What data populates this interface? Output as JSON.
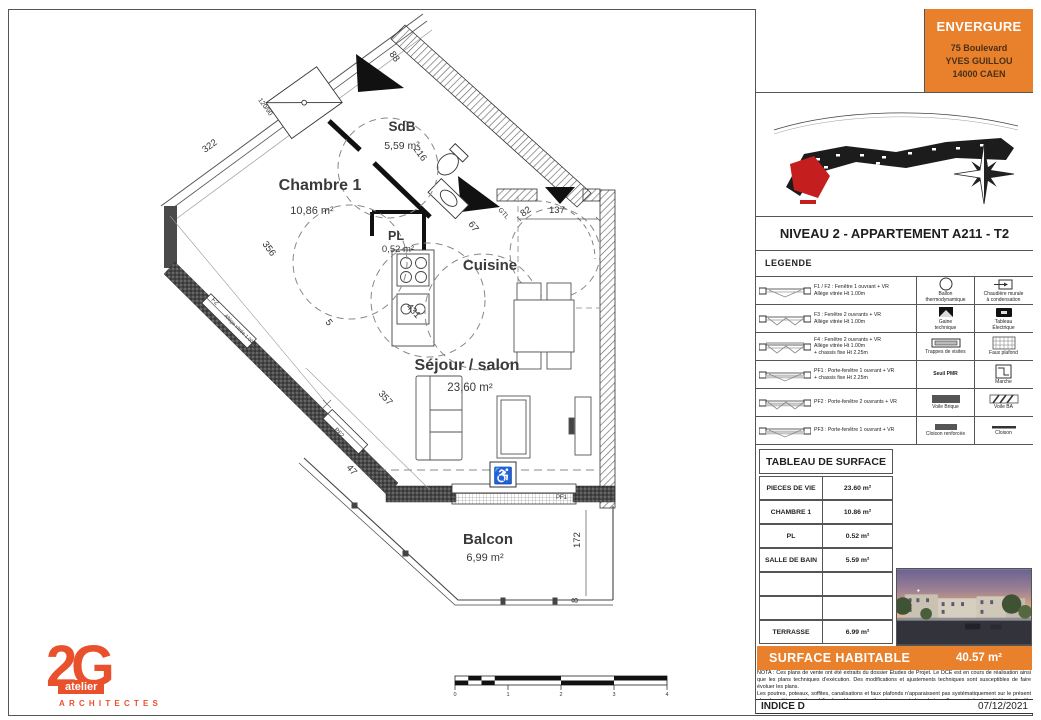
{
  "page": {
    "accent_orange": "#E8802C",
    "logo_orange": "#E8512C"
  },
  "title_block": {
    "company": "ENVERGURE",
    "address": [
      "75 Boulevard",
      "YVES GUILLOU",
      "14000 CAEN"
    ],
    "drawing_title": "NIVEAU 2 - APPARTEMENT A211 - T2",
    "indice": "INDICE D",
    "date": "07/12/2021",
    "north_label": "N"
  },
  "legend": {
    "header": "LEGENDE",
    "rows": [
      {
        "window": "F1 / F2 : Fenêtre 1 ouvrant + VR\nAllège vitrée Ht 1.00m",
        "mid_label": "Ballon\nthermodynamique",
        "mid_icon": "ballon-thermodynamique-icon",
        "right_label": "Chaudière murale\nà condensation",
        "right_icon": "chaudiere-murale-icon"
      },
      {
        "window": "F3 : Fenêtre 2 ouvrants + VR\nAllège vitrée Ht 1.00m",
        "mid_label": "Gaine\ntechnique",
        "mid_icon": "gaine-technique-icon",
        "right_label": "Tableau\nÉlectrique",
        "right_icon": "tableau-electrique-icon"
      },
      {
        "window": "F4 : Fenêtre 2 ouvrants + VR\nAllège vitrée Ht 1.00m\n+ chassis fixe Ht 2.25m",
        "mid_label": "Trappes de visites",
        "mid_icon": "trappe-visite-icon",
        "right_label": "Faux plafond",
        "right_icon": "faux-plafond-icon"
      },
      {
        "window": "PF1 : Porte-fenêtre 1 ouvrant + VR\n+ chassis fixe Ht 2.25m",
        "mid_label": "Seuil PMR",
        "mid_icon": "",
        "right_label": "Marche",
        "right_icon": "marche-icon"
      },
      {
        "window": "PF2 : Porte-fenêtre 2 ouvrants + VR",
        "mid_label": "Voile Brique",
        "mid_icon": "voile-brique-icon",
        "right_label": "Voile BA",
        "right_icon": "voile-ba-icon"
      },
      {
        "window": "PF3 : Porte-fenêtre 1 ouvrant + VR",
        "mid_label": "Cloison renforcée",
        "mid_icon": "cloison-renforcee-icon",
        "right_label": "Cloison",
        "right_icon": "cloison-icon"
      }
    ]
  },
  "surface_table": {
    "header": "TABLEAU DE SURFACE",
    "rows": [
      {
        "label": "PIECES DE VIE",
        "value": "23.60 m²"
      },
      {
        "label": "CHAMBRE 1",
        "value": "10.86 m²"
      },
      {
        "label": "PL",
        "value": "0.52 m²"
      },
      {
        "label": "SALLE DE BAIN",
        "value": "5.59 m²"
      },
      {
        "label": "",
        "value": ""
      },
      {
        "label": "",
        "value": ""
      },
      {
        "label": "TERRASSE",
        "value": "6.99 m²"
      }
    ],
    "total_label": "SURFACE HABITABLE",
    "total_value": "40.57 m²"
  },
  "nota": {
    "line1": "NOTA : Ces plans de vente ont été extraits du dossier Études de Projet. Le DCE est en cours de réalisation ainsi que les plans techniques d'exécution. Des modifications et ajustements techniques sont susceptibles de faire évoluer les plans.",
    "line2": "Les poutres, poteaux, soffites, canalisations et faux plafonds n'apparaissent pas systématiquement sur le présent plan. Les éléments de mobilier (meubles, appareils ménagers et plans de travail) ne sont placés qu'à titre indicatif."
  },
  "plan": {
    "rooms": [
      {
        "name": "SdB",
        "area": "5,59 m²"
      },
      {
        "name": "Chambre 1",
        "area": "10,86 m²"
      },
      {
        "name": "PL",
        "area": "0,52 m²"
      },
      {
        "name": "Cuisine",
        "area": ""
      },
      {
        "name": "Séjour / salon",
        "area": "23,60 m²"
      },
      {
        "name": "Balcon",
        "area": "6,99 m²"
      }
    ],
    "dims": [
      "322",
      "216",
      "88",
      "356",
      "5",
      "431",
      "67",
      "82",
      "137",
      "357",
      "47",
      "172",
      "8"
    ],
    "wall_labels": [
      "F2",
      "Allège vitrée 1.00m",
      "PF2",
      "PF1",
      "GTL",
      "120/90"
    ],
    "scale_ticks": [
      "0",
      "1",
      "2",
      "3",
      "4"
    ],
    "wheelchair_symbol": "♿"
  },
  "logo": {
    "main": "2G",
    "sub": "atelier",
    "caption": "ARCHITECTES"
  }
}
